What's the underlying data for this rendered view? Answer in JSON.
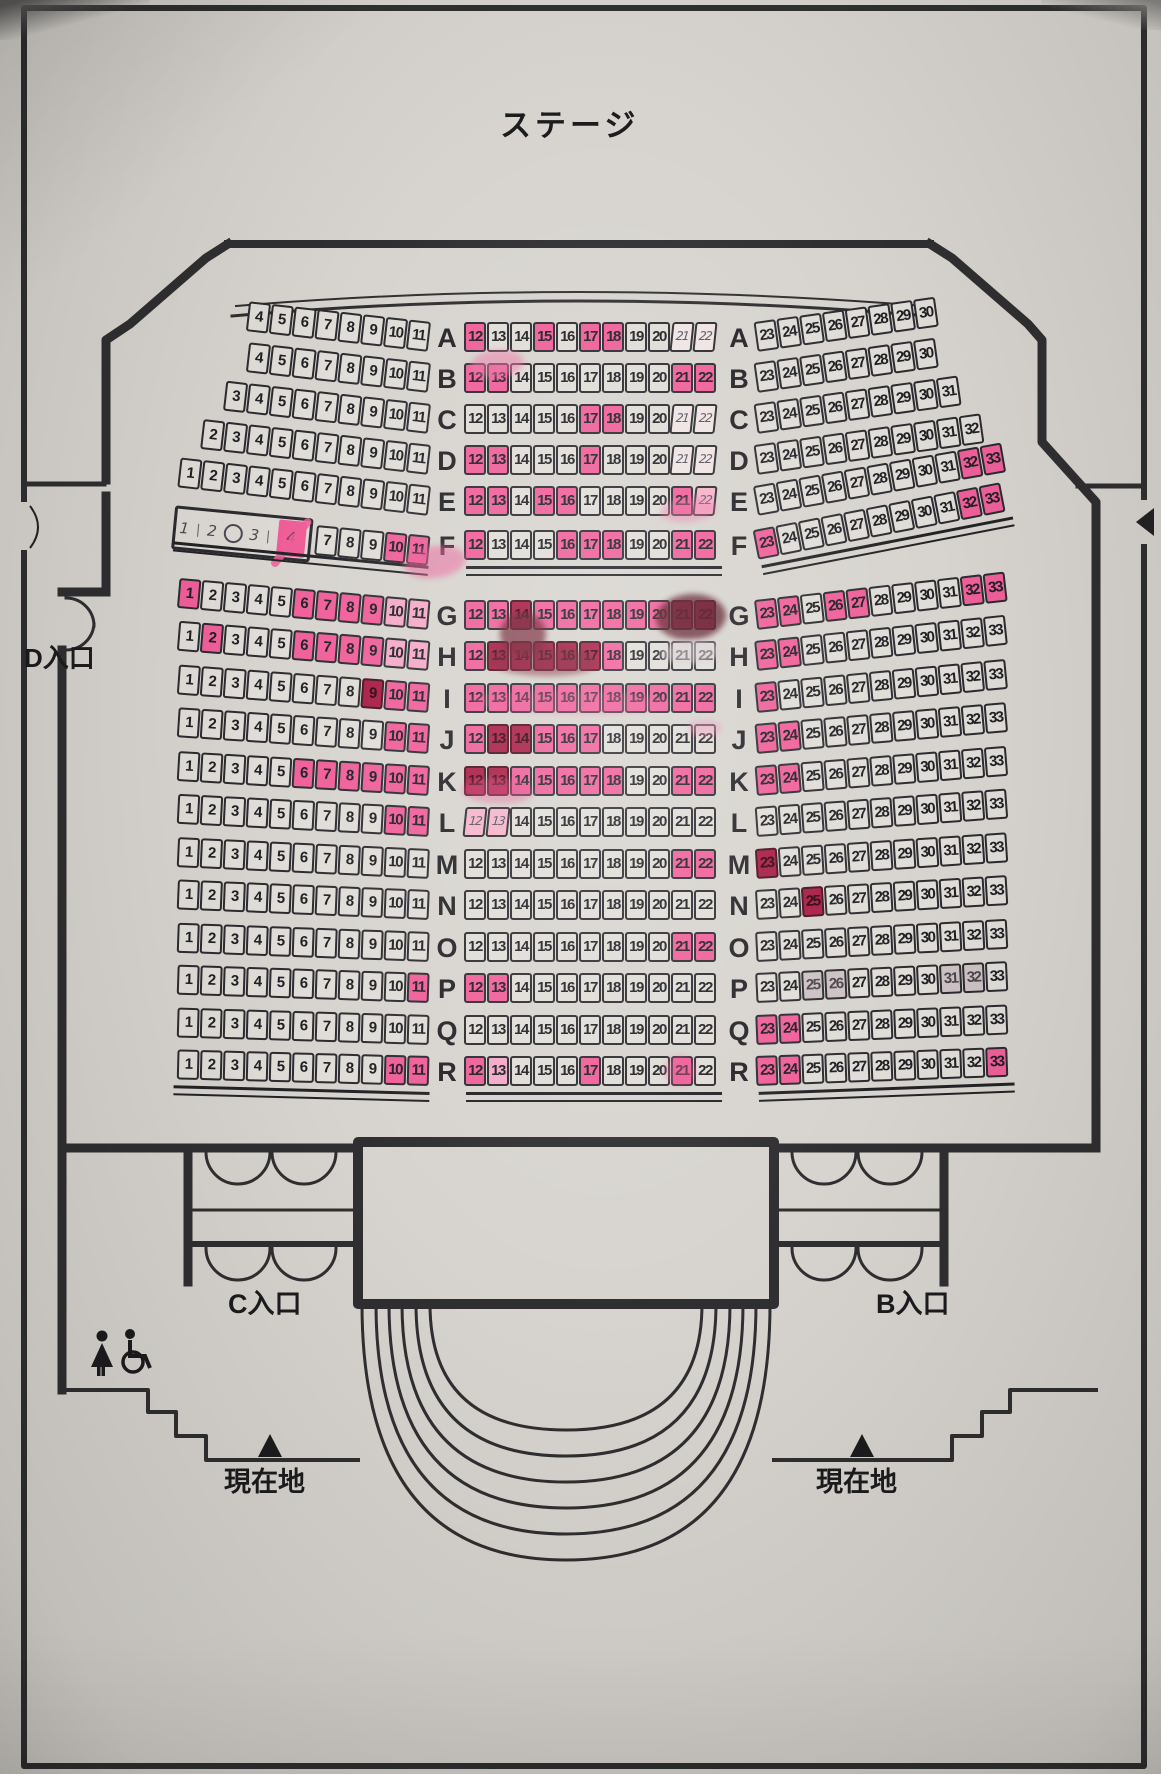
{
  "stage_label": "ステージ",
  "entrances": {
    "d": "D入口",
    "c": "C入口",
    "b": "B入口"
  },
  "current_location_label": "現在地",
  "colors": {
    "paper": "#d7d4cf",
    "ink": "#1c1c1e",
    "highlight_pink": "#ef5f99",
    "heavy_mark_red": "#a81c44",
    "light_pink": "#f4a9c6",
    "gray_smear": "#ccc2c4"
  },
  "icons": [
    "woman-icon",
    "wheelchair-icon",
    "current-location-triangle"
  ],
  "seatmap": {
    "wheelchair_box": {
      "marks": [
        "1",
        "2",
        "3",
        "4"
      ],
      "crossed": "4",
      "symbol": "wheelchair"
    },
    "state_legend": {
      "n": "unmarked",
      "p": "pink-highlight",
      "d": "heavy-dark-mark",
      "l": "light-pink",
      "h": "handwritten",
      "hp": "handwritten-pink",
      "g": "gray-smear"
    },
    "rows": [
      {
        "label": "A",
        "y": 322,
        "lt": 6.5,
        "rt": 8,
        "left": {
          "f": 4,
          "t": 11,
          "m": {}
        },
        "center": {
          "f": 12,
          "t": 22,
          "m": {
            "12": "p",
            "15": "p",
            "17": "p",
            "18": "p",
            "21": "h",
            "22": "h"
          }
        },
        "right": {
          "f": 23,
          "t": 30,
          "m": {}
        }
      },
      {
        "label": "B",
        "y": 363,
        "lt": 6.5,
        "rt": 8,
        "left": {
          "f": 4,
          "t": 11,
          "m": {}
        },
        "center": {
          "f": 12,
          "t": 22,
          "m": {
            "12": "p",
            "13": "p",
            "21": "p",
            "22": "p"
          }
        },
        "right": {
          "f": 23,
          "t": 30,
          "m": {}
        }
      },
      {
        "label": "C",
        "y": 404,
        "lt": 6.5,
        "rt": 8,
        "left": {
          "f": 3,
          "t": 11,
          "m": {}
        },
        "center": {
          "f": 12,
          "t": 22,
          "m": {
            "17": "p",
            "18": "p",
            "21": "h",
            "22": "h"
          }
        },
        "right": {
          "f": 23,
          "t": 31,
          "m": {}
        }
      },
      {
        "label": "D",
        "y": 445,
        "lt": 6.5,
        "rt": 8,
        "left": {
          "f": 2,
          "t": 11,
          "m": {}
        },
        "center": {
          "f": 12,
          "t": 22,
          "m": {
            "12": "p",
            "13": "p",
            "17": "p",
            "21": "h",
            "22": "h"
          }
        },
        "right": {
          "f": 23,
          "t": 32,
          "m": {}
        }
      },
      {
        "label": "E",
        "y": 486,
        "lt": 6.5,
        "rt": 10,
        "left": {
          "f": 1,
          "t": 11,
          "m": {}
        },
        "center": {
          "f": 12,
          "t": 22,
          "m": {
            "12": "p",
            "13": "p",
            "15": "p",
            "16": "p",
            "21": "p",
            "22": "hp"
          }
        },
        "right": {
          "f": 23,
          "t": 33,
          "m": {
            "32": "p",
            "33": "p"
          }
        }
      },
      {
        "label": "F",
        "y": 530,
        "lt": 5.5,
        "rt": 11,
        "special": "wheelchair",
        "left": {
          "f": 7,
          "t": 11,
          "m": {
            "10": "p",
            "11": "p"
          }
        },
        "center": {
          "f": 12,
          "t": 22,
          "m": {
            "12": "p",
            "16": "p",
            "17": "p",
            "18": "p",
            "21": "p",
            "22": "p"
          }
        },
        "right": {
          "f": 23,
          "t": 33,
          "m": {
            "23": "p",
            "32": "p",
            "33": "p"
          }
        },
        "u": true
      },
      {
        "label": "G",
        "y": 600,
        "lt": 5.0,
        "rt": 6.5,
        "left": {
          "f": 1,
          "t": 11,
          "m": {
            "1": "p",
            "6": "p",
            "7": "p",
            "8": "p",
            "9": "p",
            "10": "l",
            "11": "l"
          }
        },
        "center": {
          "f": 12,
          "t": 22,
          "m": {
            "12": "p",
            "13": "p",
            "14": "d",
            "15": "p",
            "16": "p",
            "17": "p",
            "18": "p",
            "19": "p",
            "20": "p",
            "21": "d",
            "22": "d"
          }
        },
        "right": {
          "f": 23,
          "t": 33,
          "m": {
            "23": "p",
            "24": "p",
            "26": "p",
            "27": "p",
            "32": "p",
            "33": "p"
          }
        }
      },
      {
        "label": "H",
        "y": 641,
        "lt": 4.6,
        "rt": 6.0,
        "left": {
          "f": 1,
          "t": 11,
          "m": {
            "2": "p",
            "6": "p",
            "7": "p",
            "8": "p",
            "9": "p",
            "10": "l",
            "11": "l"
          }
        },
        "center": {
          "f": 12,
          "t": 22,
          "m": {
            "12": "p",
            "13": "d",
            "14": "d",
            "15": "d",
            "16": "d",
            "17": "d",
            "18": "p"
          }
        },
        "right": {
          "f": 23,
          "t": 33,
          "m": {
            "23": "p",
            "24": "p"
          }
        }
      },
      {
        "label": "I",
        "y": 683,
        "lt": 4.2,
        "rt": 5.5,
        "left": {
          "f": 1,
          "t": 11,
          "m": {
            "9": "d",
            "10": "p",
            "11": "p"
          }
        },
        "center": {
          "f": 12,
          "t": 22,
          "m": {
            "12": "p",
            "13": "p",
            "14": "p",
            "15": "p",
            "16": "p",
            "17": "p",
            "18": "p",
            "19": "p",
            "20": "p",
            "21": "p",
            "22": "p"
          }
        },
        "right": {
          "f": 23,
          "t": 33,
          "m": {
            "23": "p"
          }
        }
      },
      {
        "label": "J",
        "y": 724,
        "lt": 3.8,
        "rt": 5.0,
        "left": {
          "f": 1,
          "t": 11,
          "m": {
            "10": "p",
            "11": "p"
          }
        },
        "center": {
          "f": 12,
          "t": 22,
          "m": {
            "12": "p",
            "13": "d",
            "14": "d",
            "15": "p",
            "16": "p",
            "17": "p"
          }
        },
        "right": {
          "f": 23,
          "t": 33,
          "m": {
            "23": "p",
            "24": "p"
          }
        }
      },
      {
        "label": "K",
        "y": 766,
        "lt": 3.4,
        "rt": 4.6,
        "left": {
          "f": 1,
          "t": 11,
          "m": {
            "6": "p",
            "7": "p",
            "8": "p",
            "9": "p",
            "10": "p",
            "11": "p"
          }
        },
        "center": {
          "f": 12,
          "t": 22,
          "m": {
            "12": "d",
            "13": "d",
            "14": "p",
            "15": "p",
            "16": "p",
            "17": "p",
            "18": "p",
            "21": "p",
            "22": "p"
          }
        },
        "right": {
          "f": 23,
          "t": 33,
          "m": {
            "23": "p",
            "24": "p"
          }
        }
      },
      {
        "label": "L",
        "y": 807,
        "lt": 3.0,
        "rt": 4.2,
        "left": {
          "f": 1,
          "t": 11,
          "m": {
            "10": "p",
            "11": "p"
          }
        },
        "center": {
          "f": 12,
          "t": 22,
          "m": {
            "12": "hp",
            "13": "hp"
          }
        },
        "right": {
          "f": 23,
          "t": 33,
          "m": {}
        }
      },
      {
        "label": "M",
        "y": 849,
        "lt": 2.7,
        "rt": 3.8,
        "left": {
          "f": 1,
          "t": 11,
          "m": {}
        },
        "center": {
          "f": 12,
          "t": 22,
          "m": {
            "21": "p",
            "22": "p"
          }
        },
        "right": {
          "f": 23,
          "t": 33,
          "m": {
            "23": "d"
          }
        }
      },
      {
        "label": "N",
        "y": 890,
        "lt": 2.4,
        "rt": 3.4,
        "left": {
          "f": 1,
          "t": 11,
          "m": {}
        },
        "center": {
          "f": 12,
          "t": 22,
          "m": {}
        },
        "right": {
          "f": 23,
          "t": 33,
          "m": {
            "25": "d"
          }
        }
      },
      {
        "label": "O",
        "y": 932,
        "lt": 2.1,
        "rt": 3.0,
        "left": {
          "f": 1,
          "t": 11,
          "m": {}
        },
        "center": {
          "f": 12,
          "t": 22,
          "m": {
            "21": "p",
            "22": "p"
          }
        },
        "right": {
          "f": 23,
          "t": 33,
          "m": {}
        }
      },
      {
        "label": "P",
        "y": 973,
        "lt": 1.9,
        "rt": 2.7,
        "left": {
          "f": 1,
          "t": 11,
          "m": {
            "11": "p"
          }
        },
        "center": {
          "f": 12,
          "t": 22,
          "m": {
            "12": "p",
            "13": "p"
          }
        },
        "right": {
          "f": 23,
          "t": 33,
          "m": {
            "25": "g",
            "26": "g",
            "31": "g",
            "32": "g"
          }
        }
      },
      {
        "label": "Q",
        "y": 1015,
        "lt": 1.7,
        "rt": 2.4,
        "left": {
          "f": 1,
          "t": 11,
          "m": {}
        },
        "center": {
          "f": 12,
          "t": 22,
          "m": {}
        },
        "right": {
          "f": 23,
          "t": 33,
          "m": {
            "23": "p",
            "24": "p"
          }
        }
      },
      {
        "label": "R",
        "y": 1056,
        "lt": 1.5,
        "rt": 2.1,
        "left": {
          "f": 1,
          "t": 11,
          "m": {
            "10": "p",
            "11": "p"
          }
        },
        "center": {
          "f": 12,
          "t": 22,
          "m": {
            "12": "p",
            "13": "l",
            "17": "p",
            "21": "p"
          }
        },
        "right": {
          "f": 23,
          "t": 33,
          "m": {
            "23": "p",
            "24": "p",
            "33": "p"
          }
        },
        "u": true
      }
    ]
  },
  "marker_smudges": [
    {
      "x": 470,
      "y": 350,
      "w": 54,
      "h": 28,
      "c": "#ef74a5",
      "o": 0.5,
      "r": -6
    },
    {
      "x": 500,
      "y": 612,
      "w": 46,
      "h": 44,
      "c": "#6e1b2d",
      "o": 0.7,
      "r": 6
    },
    {
      "x": 656,
      "y": 594,
      "w": 70,
      "h": 46,
      "c": "#591523",
      "o": 0.75,
      "r": -4
    },
    {
      "x": 660,
      "y": 640,
      "w": 62,
      "h": 24,
      "c": "#d9cdd2",
      "o": 0.55,
      "r": -3
    },
    {
      "x": 486,
      "y": 646,
      "w": 112,
      "h": 30,
      "c": "#7c1f33",
      "o": 0.5,
      "r": 2
    },
    {
      "x": 470,
      "y": 690,
      "w": 200,
      "h": 24,
      "c": "#ee5c96",
      "o": 0.3,
      "r": 1
    },
    {
      "x": 404,
      "y": 546,
      "w": 62,
      "h": 32,
      "c": "#ee5c96",
      "o": 0.5,
      "r": -8
    },
    {
      "x": 462,
      "y": 778,
      "w": 72,
      "h": 26,
      "c": "#e84b8a",
      "o": 0.35,
      "r": 2
    },
    {
      "x": 660,
      "y": 498,
      "w": 56,
      "h": 24,
      "c": "#f06fa2",
      "o": 0.4,
      "r": -5
    },
    {
      "x": 688,
      "y": 720,
      "w": 34,
      "h": 16,
      "c": "#f095b8",
      "o": 0.45,
      "r": 0
    },
    {
      "x": 664,
      "y": 1056,
      "w": 32,
      "h": 30,
      "c": "#ee5c96",
      "o": 0.35,
      "r": 0
    }
  ]
}
